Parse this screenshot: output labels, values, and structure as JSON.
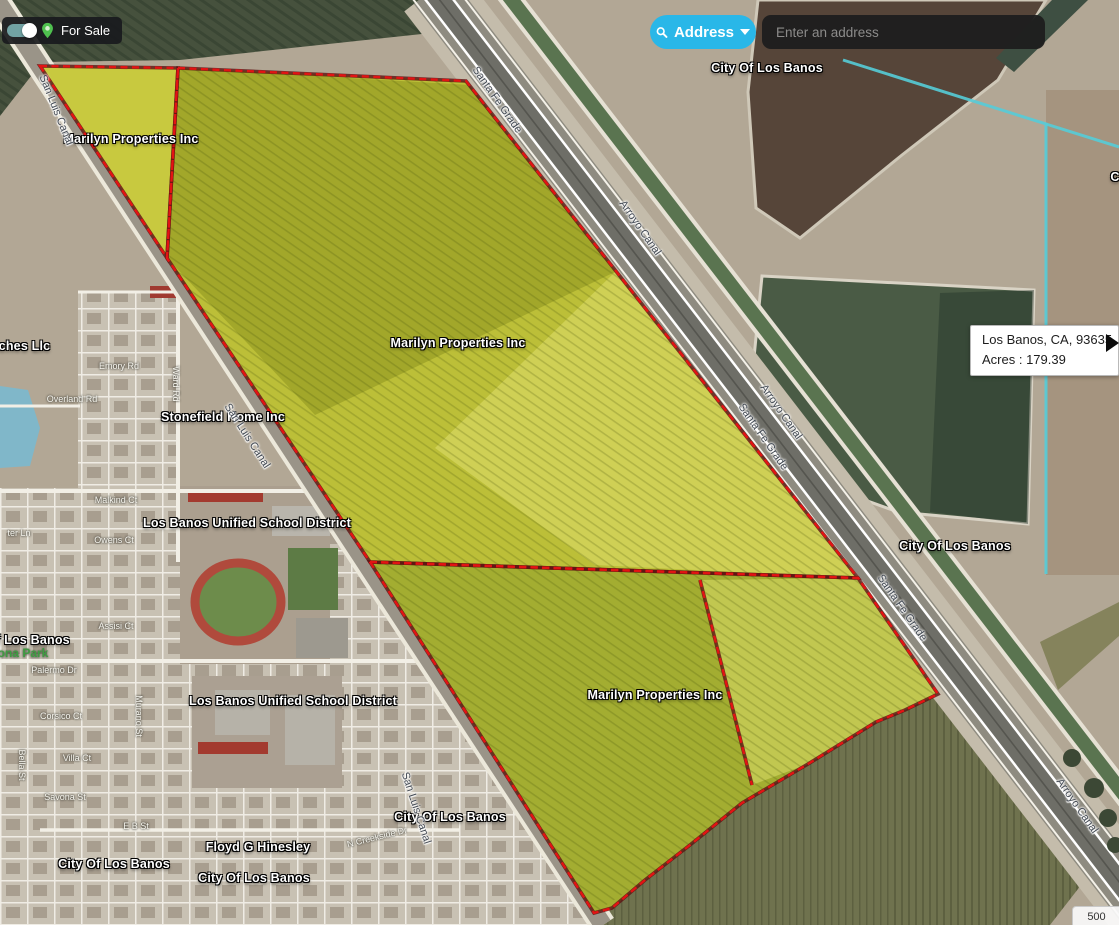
{
  "theme": {
    "accent-cyan": "#29b7e8",
    "toggle-teal": "#71a2a3",
    "pin-green": "#4fc14f",
    "parcel-yellow": "#bcbf38",
    "parcel-olive": "#a3ad31",
    "boundary-red": "#e31313",
    "city-boundary-cyan": "#55ccd8",
    "searchbar-bg": "#1e1e1e",
    "tooltip-bg": "#ffffff"
  },
  "controls": {
    "for_sale": {
      "label": "For Sale",
      "state": "on"
    },
    "address_search": {
      "button_label": "Address",
      "placeholder": "Enter an address",
      "value": ""
    },
    "tooltip": {
      "location": "Los Banos, CA, 93635",
      "acres": "Acres : 179.39"
    },
    "scale_indicator": {
      "value": "500"
    }
  },
  "map": {
    "owner_labels": [
      {
        "text": "City Of Los Banos",
        "x": 767,
        "y": 68
      },
      {
        "text": "Marilyn Properties Inc",
        "x": 131,
        "y": 139
      },
      {
        "text": "Marilyn Properties Inc",
        "x": 458,
        "y": 343
      },
      {
        "text": "Marilyn Properties Inc",
        "x": 655,
        "y": 695
      },
      {
        "text": "Stonefield Home Inc",
        "x": 223,
        "y": 417
      },
      {
        "text": "Los Banos Unified School District",
        "x": 247,
        "y": 523
      },
      {
        "text": "Los Banos Unified School District",
        "x": 293,
        "y": 701
      },
      {
        "text": "City Of Los Banos",
        "x": 955,
        "y": 546
      },
      {
        "text": "City Of Los Banos",
        "x": 450,
        "y": 817
      },
      {
        "text": "Floyd G Hinesley",
        "x": 258,
        "y": 847
      },
      {
        "text": "City Of Los Banos",
        "x": 254,
        "y": 878
      },
      {
        "text": "City Of Los Banos",
        "x": 114,
        "y": 864
      },
      {
        "text": "Of Los Banos",
        "x": 28,
        "y": 640
      },
      {
        "text": "anches Llc",
        "x": 17,
        "y": 346
      },
      {
        "text": "C",
        "x": 1115,
        "y": 177
      }
    ],
    "road_labels": [
      {
        "text": "Santa Fe Grade",
        "x": 497,
        "y": 100,
        "rot": 55
      },
      {
        "text": "Arroyo Canal",
        "x": 640,
        "y": 228,
        "rot": 55
      },
      {
        "text": "Arroyo Canal",
        "x": 781,
        "y": 412,
        "rot": 55
      },
      {
        "text": "Santa Fe Grade",
        "x": 763,
        "y": 437,
        "rot": 55
      },
      {
        "text": "Santa Fe Grade",
        "x": 902,
        "y": 608,
        "rot": 55
      },
      {
        "text": "Arroyo Canal",
        "x": 1077,
        "y": 806,
        "rot": 55
      },
      {
        "text": "San Luis Canal",
        "x": 247,
        "y": 436,
        "rot": 57
      },
      {
        "text": "San Luis Canal",
        "x": 416,
        "y": 808,
        "rot": 72
      },
      {
        "text": "San Luis Canal",
        "x": 56,
        "y": 110,
        "rot": 68
      }
    ],
    "street_labels": [
      {
        "text": "Overland Rd",
        "x": 72,
        "y": 399,
        "rot": 0
      },
      {
        "text": "Ward Rd",
        "x": 176,
        "y": 384,
        "rot": 90
      },
      {
        "text": "Emory Rd",
        "x": 119,
        "y": 366,
        "rot": 0
      },
      {
        "text": "Malkind Ct",
        "x": 116,
        "y": 500,
        "rot": 0
      },
      {
        "text": "Owens Ct",
        "x": 114,
        "y": 540,
        "rot": 0
      },
      {
        "text": "ter Ln",
        "x": 19,
        "y": 533,
        "rot": 0
      },
      {
        "text": "Assisi Ct",
        "x": 116,
        "y": 626,
        "rot": 0
      },
      {
        "text": "Palermo Dr",
        "x": 54,
        "y": 670,
        "rot": 0
      },
      {
        "text": "Corsico Ct",
        "x": 61,
        "y": 716,
        "rot": 0
      },
      {
        "text": "Villa Ct",
        "x": 77,
        "y": 758,
        "rot": 0
      },
      {
        "text": "Savona St",
        "x": 65,
        "y": 797,
        "rot": 0
      },
      {
        "text": "Bella St",
        "x": 22,
        "y": 765,
        "rot": 90
      },
      {
        "text": "Murano St",
        "x": 139,
        "y": 716,
        "rot": 90
      },
      {
        "text": "E B St",
        "x": 136,
        "y": 826,
        "rot": 0
      },
      {
        "text": "N Creekside Dr",
        "x": 377,
        "y": 837,
        "rot": -14
      }
    ],
    "park_labels": [
      {
        "text": "ona Park",
        "x": 23,
        "y": 653,
        "rot": 0
      }
    ]
  }
}
